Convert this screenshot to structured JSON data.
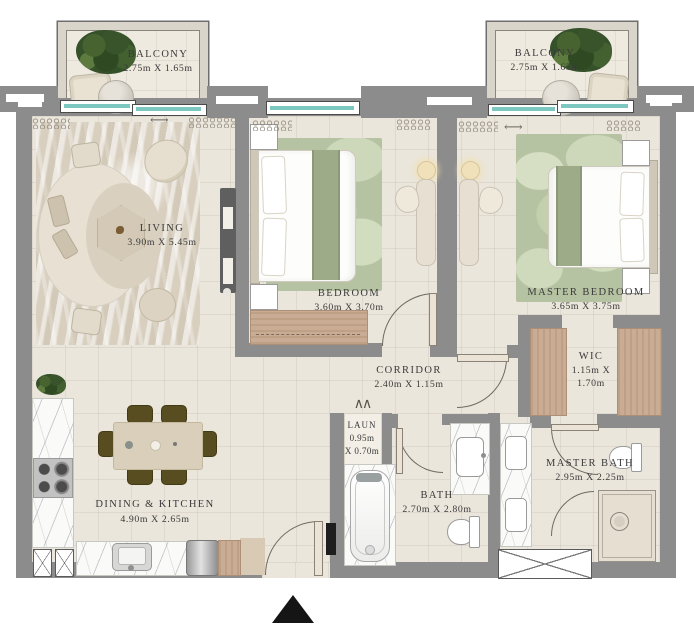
{
  "plan": {
    "colors": {
      "wall": "#8c8c8c",
      "floor": "#ebe6dc",
      "window_glass": "#7cc8c1",
      "rug_green": "#b6c3a2",
      "rug_beige": "#d8cfbf",
      "wood": "#c9ac93",
      "marble": "#fafaf8",
      "dining_chair": "#574d20",
      "label_text": "#3a3a3a",
      "entry_marker": "#151515"
    },
    "rooms": {
      "balcony_left": {
        "name": "BALCONY",
        "dims": "2.75m X 1.65m"
      },
      "balcony_right": {
        "name": "BALCONY",
        "dims": "2.75m X 1.65m"
      },
      "living": {
        "name": "LIVING",
        "dims": "3.90m X 5.45m"
      },
      "bedroom": {
        "name": "BEDROOM",
        "dims": "3.60m X 3.70m"
      },
      "master_bedroom": {
        "name": "MASTER BEDROOM",
        "dims": "3.65m X 3.75m"
      },
      "corridor": {
        "name": "CORRIDOR",
        "dims": "2.40m X 1.15m"
      },
      "wic": {
        "name": "WIC",
        "dims_line1": "1.15m X",
        "dims_line2": "1.70m"
      },
      "laundry": {
        "name": "LAUN",
        "dims_line1": "0.95m",
        "dims_line2": "X 0.70m"
      },
      "bath": {
        "name": "BATH",
        "dims": "2.70m X 2.80m"
      },
      "master_bath": {
        "name": "MASTER BATH",
        "dims": "2.95m X 2.25m"
      },
      "dining_kitchen": {
        "name": "DINING & KITCHEN",
        "dims": "4.90m X 2.65m"
      }
    },
    "symbols": {
      "door_arrow": "⟷",
      "bifold_door": "∧∧"
    }
  }
}
